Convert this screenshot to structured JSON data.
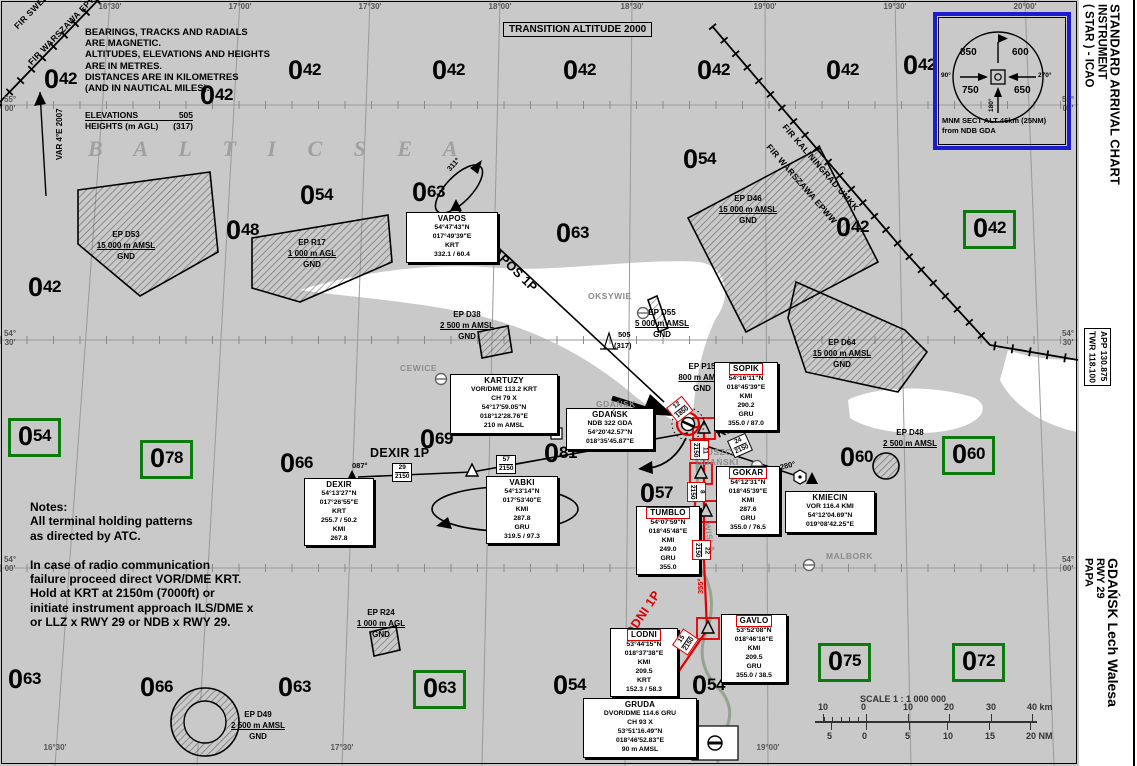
{
  "margin": {
    "title_lines": [
      "STANDARD ARRIVAL CHART",
      "INSTRUMENT",
      "( STAR ) - ICAO"
    ],
    "freq_lines": [
      "APP  130.875",
      "TWR  118.100"
    ],
    "airport_lines": [
      "GDAŃSK Lech Walesa",
      "RWY 29",
      "PAPA"
    ]
  },
  "header": {
    "transition": "TRANSITION ALTITUDE 2000",
    "mag_note": [
      "BEARINGS, TRACKS AND RADIALS",
      "ARE MAGNETIC.",
      "ALTITUDES, ELEVATIONS AND HEIGHTS",
      "ARE IN METRES.",
      "DISTANCES ARE IN KILOMETRES",
      "(AND IN  NAUTICAL MILES)."
    ],
    "elev_legend": {
      "l1": "ELEVATIONS",
      "v1": "505",
      "l2": "HEIGHTS (m AGL)",
      "v2": "(317)"
    },
    "var_label": "VAR 4°E 2007",
    "fir_nw1": "FIR SWEDEN ESAA",
    "fir_nw2": "FIR WARSZAWA EPWW",
    "fir_ne1": "FIR KALININGRAD UMKK",
    "fir_ne2": "FIR WARSZAWA EPWW",
    "sea_label": "B A L T I C   S E A"
  },
  "rose": {
    "tl": "850",
    "tr": "600",
    "bl": "750",
    "br": "650",
    "left": "90°",
    "right": "270°",
    "bottom": "180°",
    "caption1": "MNM SECT ALT 46km (25NM)",
    "caption2": "from NDB GDA"
  },
  "notes": [
    "Notes:",
    "All terminal holding patterns",
    "as directed by ATC.",
    "",
    "In case of radio communication",
    "failure proceed direct VOR/DME KRT.",
    "Hold at KRT at 2150m (7000ft) or",
    "initiate instrument approach ILS/DME x",
    "or LLZ x RWY 29 or NDB x RWY 29."
  ],
  "scale": {
    "title": "SCALE  1 : 1 000 000",
    "km": [
      "10",
      "0",
      "10",
      "20",
      "30",
      "40 km"
    ],
    "nm": [
      "5",
      "0",
      "5",
      "10",
      "15",
      "20 NM"
    ]
  },
  "obstacle": {
    "elev": "505",
    "height": "(317)"
  },
  "msa_values": [
    {
      "v": "042",
      "x": 44,
      "y": 64,
      "g": 0
    },
    {
      "v": "042",
      "x": 200,
      "y": 80,
      "g": 0
    },
    {
      "v": "042",
      "x": 288,
      "y": 55,
      "g": 0
    },
    {
      "v": "042",
      "x": 432,
      "y": 55,
      "g": 0
    },
    {
      "v": "042",
      "x": 563,
      "y": 55,
      "g": 0
    },
    {
      "v": "042",
      "x": 697,
      "y": 55,
      "g": 0
    },
    {
      "v": "042",
      "x": 826,
      "y": 55,
      "g": 0
    },
    {
      "v": "042",
      "x": 903,
      "y": 50,
      "g": 0
    },
    {
      "v": "042",
      "x": 836,
      "y": 212,
      "g": 0
    },
    {
      "v": "042",
      "x": 28,
      "y": 272,
      "g": 0
    },
    {
      "v": "054",
      "x": 300,
      "y": 180,
      "g": 0
    },
    {
      "v": "054",
      "x": 683,
      "y": 144,
      "g": 0
    },
    {
      "v": "054",
      "x": 553,
      "y": 670,
      "g": 0
    },
    {
      "v": "054",
      "x": 692,
      "y": 670,
      "g": 0
    },
    {
      "v": "048",
      "x": 226,
      "y": 215,
      "g": 0
    },
    {
      "v": "063",
      "x": 412,
      "y": 177,
      "g": 0
    },
    {
      "v": "063",
      "x": 556,
      "y": 218,
      "g": 0
    },
    {
      "v": "063",
      "x": 8,
      "y": 664,
      "g": 0
    },
    {
      "v": "063",
      "x": 278,
      "y": 672,
      "g": 0
    },
    {
      "v": "066",
      "x": 140,
      "y": 672,
      "g": 0
    },
    {
      "v": "066",
      "x": 280,
      "y": 448,
      "g": 0
    },
    {
      "v": "069",
      "x": 420,
      "y": 424,
      "g": 0
    },
    {
      "v": "081",
      "x": 544,
      "y": 438,
      "g": 0
    },
    {
      "v": "057",
      "x": 640,
      "y": 478,
      "g": 0
    },
    {
      "v": "060",
      "x": 840,
      "y": 442,
      "g": 0
    },
    {
      "v": "042",
      "x": 963,
      "y": 210,
      "g": 1
    },
    {
      "v": "054",
      "x": 8,
      "y": 418,
      "g": 1
    },
    {
      "v": "078",
      "x": 140,
      "y": 440,
      "g": 1
    },
    {
      "v": "060",
      "x": 942,
      "y": 436,
      "g": 1
    },
    {
      "v": "063",
      "x": 413,
      "y": 670,
      "g": 1
    },
    {
      "v": "075",
      "x": 818,
      "y": 643,
      "g": 1
    },
    {
      "v": "072",
      "x": 952,
      "y": 643,
      "g": 1
    }
  ],
  "grid": {
    "top": [
      [
        "16°",
        "30'",
        110
      ],
      [
        "17°",
        "00'",
        240
      ],
      [
        "17°",
        "30'",
        370
      ],
      [
        "18°",
        "00'",
        500
      ],
      [
        "18°",
        "30'",
        632
      ],
      [
        "19°",
        "00'",
        765
      ],
      [
        "19°",
        "30'",
        895
      ],
      [
        "20°",
        "00'",
        1025
      ]
    ],
    "bottom": [
      [
        "16°",
        "30'",
        55
      ],
      [
        "17°",
        "30'",
        342
      ],
      [
        "18°",
        "30'",
        625
      ],
      [
        "19°",
        "00'",
        768
      ]
    ],
    "left": [
      [
        "55°",
        "00'",
        96
      ],
      [
        "54°",
        "30'",
        330
      ],
      [
        "54°",
        "00'",
        556
      ]
    ],
    "right": [
      [
        "55°",
        "00'",
        96
      ],
      [
        "54°",
        "30'",
        330
      ],
      [
        "54°",
        "00'",
        556
      ]
    ]
  },
  "navboxes": [
    {
      "n": "vapos",
      "x": 406,
      "y": 212,
      "w": 88,
      "red": 0,
      "title": "VAPOS",
      "lines": [
        "54°47'43\"N",
        "017°49'39\"E",
        "KRT",
        "332.1 / 60.4"
      ]
    },
    {
      "n": "kartuzy",
      "x": 450,
      "y": 374,
      "w": 104,
      "red": 0,
      "title": "KARTUZY",
      "lines": [
        "VOR/DME 113.2 KRT",
        "CH 79 X",
        "54°17'59.05\"N",
        "018°12'28.76\"E",
        "210 m AMSL"
      ]
    },
    {
      "n": "gdansk-ndb",
      "x": 566,
      "y": 408,
      "w": 84,
      "red": 0,
      "title": "GDAŃSK",
      "lines": [
        "NDB 322 GDA",
        "54°20'42.57\"N",
        "018°35'45.87\"E"
      ]
    },
    {
      "n": "sopik",
      "x": 714,
      "y": 362,
      "w": 60,
      "red": 1,
      "title": "SOPIK",
      "lines": [
        "54°16'11\"N",
        "018°45'39\"E",
        "KMI",
        "290.2",
        "GRU",
        "355.0 / 87.0"
      ]
    },
    {
      "n": "gokar",
      "x": 716,
      "y": 466,
      "w": 60,
      "red": 1,
      "title": "GOKAR",
      "lines": [
        "54°12'31\"N",
        "018°45'39\"E",
        "KMI",
        "287.6",
        "GRU",
        "355.0 / 76.5"
      ]
    },
    {
      "n": "kmiecin",
      "x": 785,
      "y": 491,
      "w": 86,
      "red": 0,
      "title": "KMIECIN",
      "lines": [
        "VOR 116.4 KMI",
        "54°12'04.69\"N",
        "019°08'42.25\"E"
      ]
    },
    {
      "n": "tumblo",
      "x": 636,
      "y": 506,
      "w": 60,
      "red": 1,
      "title": "TUMBLO",
      "lines": [
        "54°07'59\"N",
        "018°45'48\"E",
        "KMI",
        "249.0",
        "GRU",
        "355.0"
      ]
    },
    {
      "n": "dexir",
      "x": 304,
      "y": 478,
      "w": 66,
      "red": 0,
      "title": "DEXIR",
      "lines": [
        "54°13'27\"N",
        "017°26'55\"E",
        "KRT",
        "255.7 / 50.2",
        "KMI",
        "267.8"
      ]
    },
    {
      "n": "vabki",
      "x": 486,
      "y": 476,
      "w": 68,
      "red": 0,
      "title": "VABKI",
      "lines": [
        "54°13'14\"N",
        "017°53'40\"E",
        "KMI",
        "287.8",
        "GRU",
        "319.5 / 97.3"
      ]
    },
    {
      "n": "lodni",
      "x": 610,
      "y": 628,
      "w": 64,
      "red": 1,
      "title": "LODNI",
      "lines": [
        "53°44'15\"N",
        "018°37'38\"E",
        "KMI",
        "209.5",
        "KRT",
        "152.3 / 58.3"
      ]
    },
    {
      "n": "gavlo",
      "x": 721,
      "y": 614,
      "w": 62,
      "red": 1,
      "title": "GAVLO",
      "lines": [
        "53°52'08\"N",
        "018°46'16\"E",
        "KMI",
        "209.5",
        "GRU",
        "355.0 / 38.5"
      ]
    },
    {
      "n": "gruda",
      "x": 583,
      "y": 698,
      "w": 110,
      "red": 0,
      "title": "GRUDA",
      "lines": [
        "DVOR/DME 114.6 GRU",
        "CH 93 X",
        "53°51'16.49\"N",
        "018°46'52.83\"E",
        "90 m AMSL"
      ]
    }
  ],
  "areas": [
    {
      "n": "ep-d53",
      "lines": [
        "EP D53",
        "15 000 m AMSL",
        "GND"
      ],
      "x": 86,
      "y": 230,
      "w": 80
    },
    {
      "n": "ep-r17",
      "lines": [
        "EP R17",
        "1 000 m AGL",
        "GND"
      ],
      "x": 272,
      "y": 238,
      "w": 80
    },
    {
      "n": "ep-d46",
      "lines": [
        "EP D46",
        "15 000 m AMSL",
        "GND"
      ],
      "x": 706,
      "y": 194,
      "w": 84
    },
    {
      "n": "ep-d64",
      "lines": [
        "EP D64",
        "15 000 m AMSL",
        "GND"
      ],
      "x": 800,
      "y": 338,
      "w": 84
    },
    {
      "n": "ep-d38",
      "lines": [
        "EP D38",
        "2 500 m AMSL",
        "GND"
      ],
      "x": 428,
      "y": 310,
      "w": 78
    },
    {
      "n": "ep-d55",
      "lines": [
        "EP D55",
        "5 000 m AMSL",
        "GND"
      ],
      "x": 622,
      "y": 308,
      "w": 80
    },
    {
      "n": "ep-p15",
      "lines": [
        "EP P15",
        "800 m AMSL",
        "GND"
      ],
      "x": 664,
      "y": 362,
      "w": 76
    },
    {
      "n": "ep-d48",
      "lines": [
        "EP D48",
        "2 500 m AMSL"
      ],
      "x": 872,
      "y": 428,
      "w": 76
    },
    {
      "n": "ep-r24",
      "lines": [
        "EP R24",
        "1 000 m AGL",
        "GND"
      ],
      "x": 342,
      "y": 608,
      "w": 78
    },
    {
      "n": "ep-d49",
      "lines": [
        "EP D49",
        "2 500 m AMSL",
        "GND"
      ],
      "x": 218,
      "y": 710,
      "w": 80
    }
  ],
  "route_labels": [
    {
      "t": "VAPOS 1P",
      "x": 494,
      "y": 240,
      "r": 44,
      "c": "rtname"
    },
    {
      "t": "131°",
      "x": 476,
      "y": 224,
      "r": 44,
      "c": "brg"
    },
    {
      "t": "311°",
      "x": 445,
      "y": 167,
      "r": -48,
      "c": "brg"
    },
    {
      "t": "DEXIR 1P",
      "x": 370,
      "y": 446,
      "r": 0,
      "c": "rtname"
    },
    {
      "t": "087°",
      "x": 352,
      "y": 461,
      "r": 0,
      "c": "brg"
    },
    {
      "t": "267°",
      "x": 487,
      "y": 508,
      "r": 0,
      "c": "brg"
    },
    {
      "t": "KMI 1P",
      "x": 714,
      "y": 428,
      "r": -24,
      "c": "rtname"
    },
    {
      "t": "280°",
      "x": 779,
      "y": 463,
      "r": -14,
      "c": "brg"
    },
    {
      "t": "LODNI 1P",
      "x": 618,
      "y": 638,
      "r": -56,
      "c": "rtname red"
    },
    {
      "t": "355°",
      "x": 696,
      "y": 594,
      "r": -90,
      "c": "brg red"
    },
    {
      "t": "70°",
      "x": 645,
      "y": 437,
      "r": -35,
      "c": "brg"
    }
  ],
  "fix_boxes": [
    {
      "d": "29",
      "a": "2150",
      "x": 392,
      "y": 463,
      "r": 0,
      "red": 0,
      "v": 0
    },
    {
      "d": "57",
      "a": "2150",
      "x": 496,
      "y": 455,
      "r": 0,
      "red": 0,
      "v": 0
    },
    {
      "d": "24",
      "a": "2150",
      "x": 727,
      "y": 441,
      "r": -24,
      "red": 0,
      "v": 0
    },
    {
      "d": "12",
      "a": "1850",
      "x": 666,
      "y": 408,
      "r": -38,
      "red": 1,
      "v": 0
    },
    {
      "d": "11",
      "a": "2150",
      "x": 690,
      "y": 440,
      "r": 0,
      "red": 1,
      "v": 1
    },
    {
      "d": "8",
      "a": "2150",
      "x": 687,
      "y": 482,
      "r": 0,
      "red": 1,
      "v": 1
    },
    {
      "d": "22",
      "a": "2150",
      "x": 692,
      "y": 540,
      "r": 0,
      "red": 1,
      "v": 1
    },
    {
      "d": "15",
      "a": "2150",
      "x": 672,
      "y": 645,
      "r": -56,
      "red": 1,
      "v": 0
    }
  ],
  "places": [
    {
      "t": "OKSYWIE",
      "x": 588,
      "y": 291,
      "r": 0
    },
    {
      "t": "CEWICE",
      "x": 400,
      "y": 363,
      "r": 0
    },
    {
      "t": "GDAŃSK",
      "x": 596,
      "y": 399,
      "r": 0
    },
    {
      "t": "PRUSZCZ",
      "x": 694,
      "y": 447,
      "r": 0
    },
    {
      "t": "GDAŃSKI",
      "x": 696,
      "y": 457,
      "r": 0
    },
    {
      "t": "MALBORK",
      "x": 826,
      "y": 551,
      "r": 0
    },
    {
      "t": "WISŁA",
      "x": 712,
      "y": 522,
      "r": 80
    }
  ]
}
